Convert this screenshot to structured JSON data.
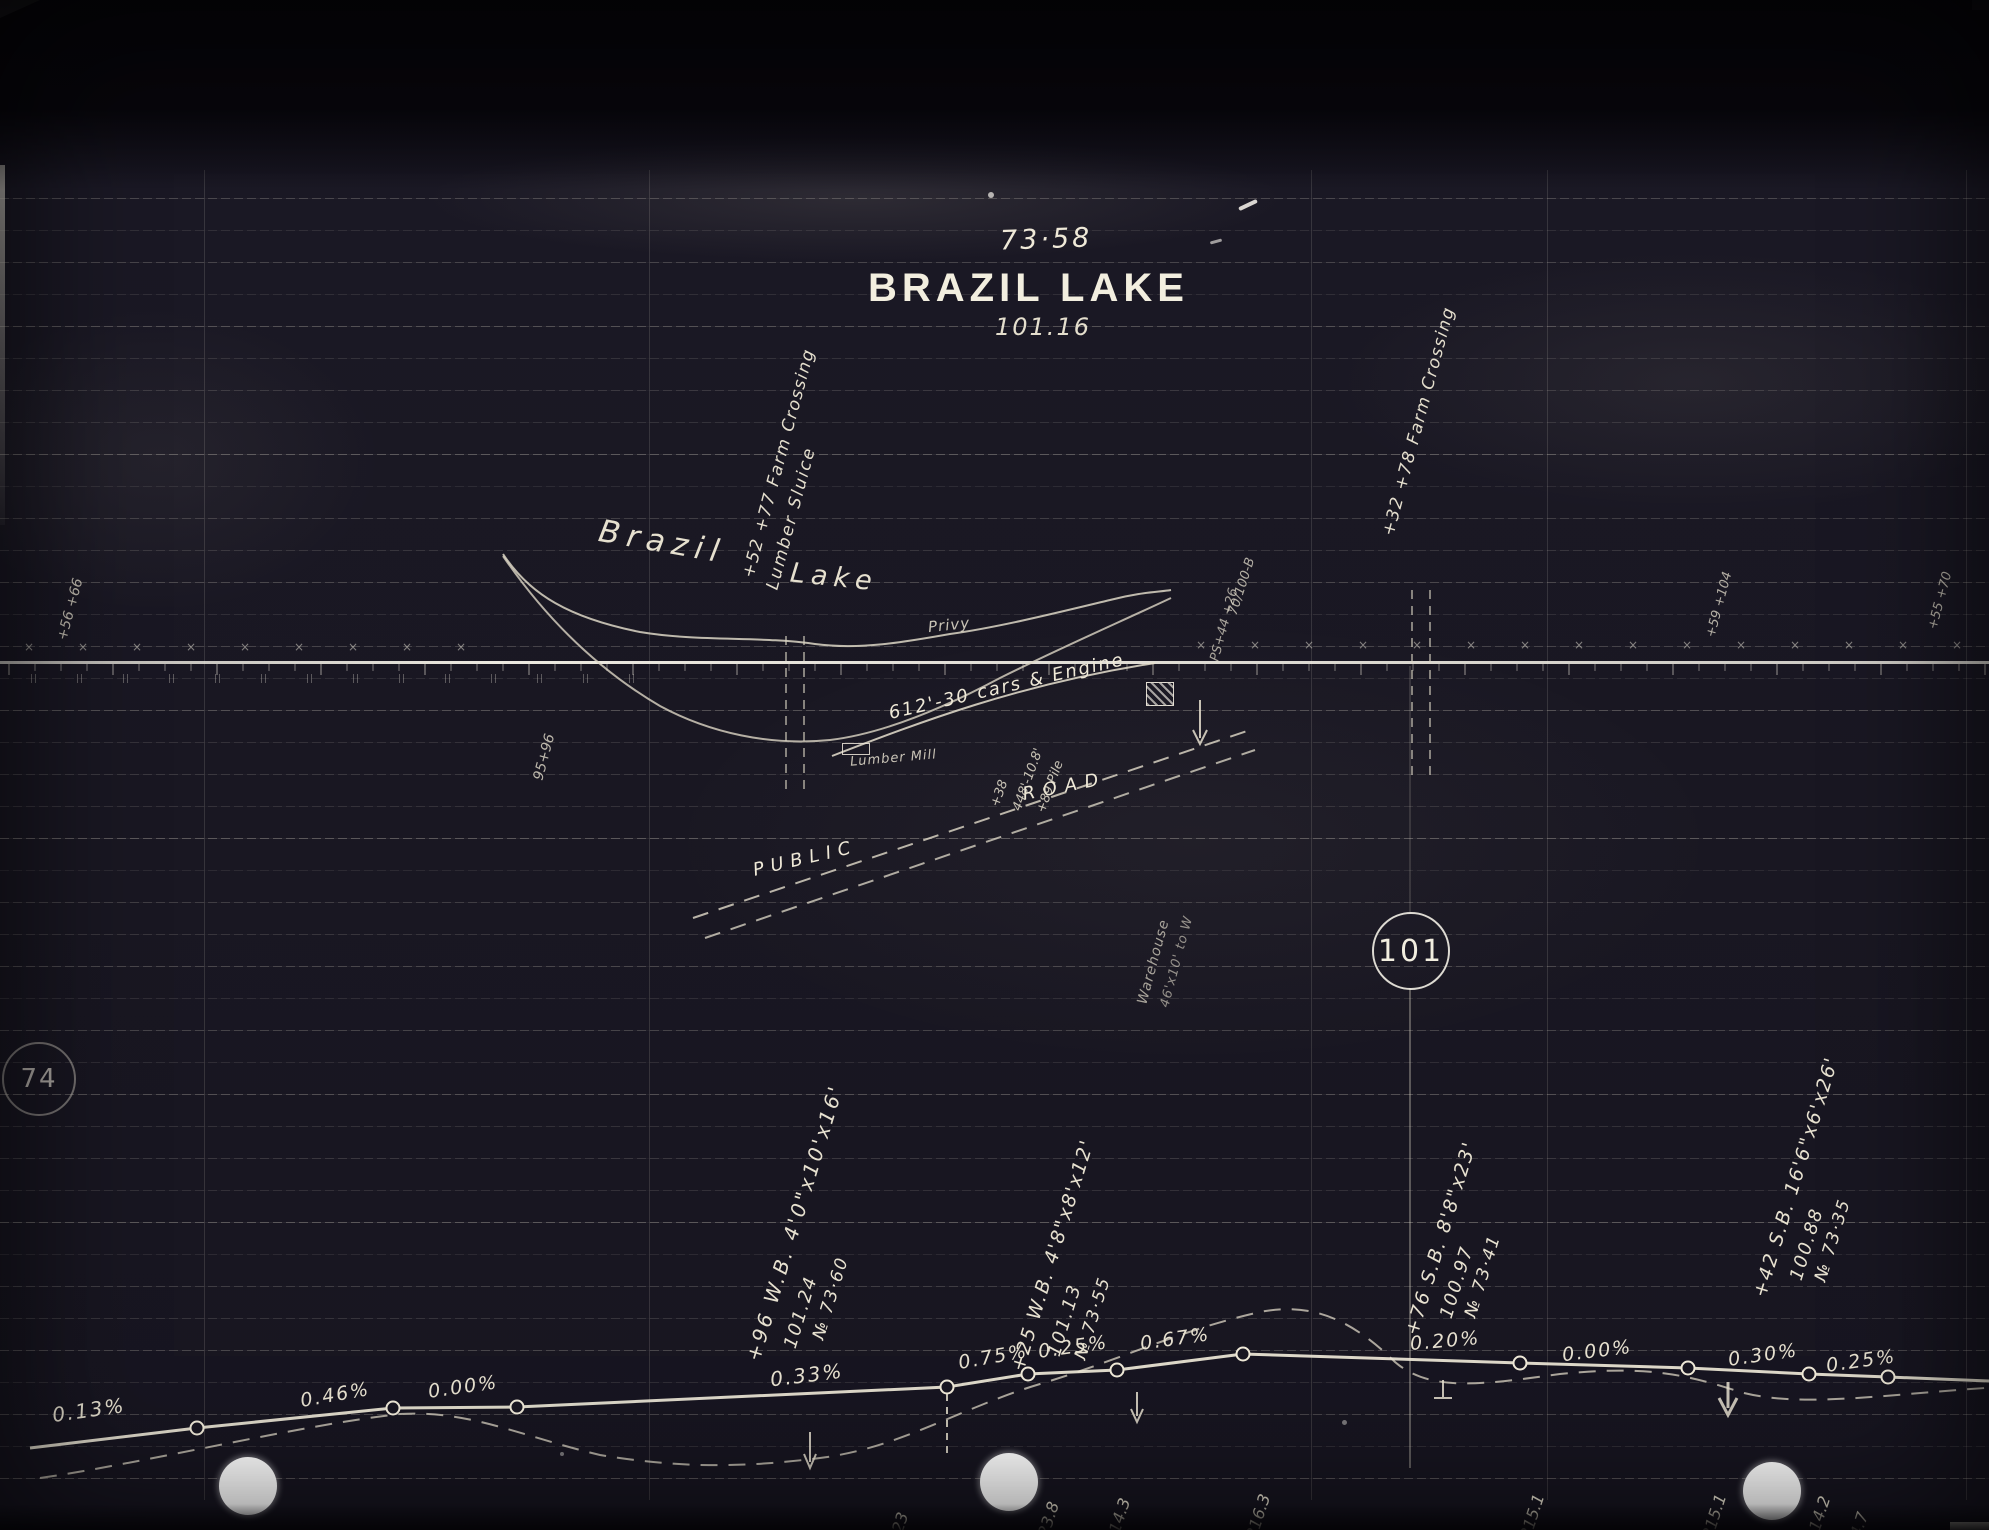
{
  "colors": {
    "paper": "#191722",
    "ink": "#e9e3d2",
    "ink_bright": "#f7f4ea",
    "grid": "#cfc9b8",
    "hole": "#ffffff"
  },
  "title": {
    "mileage_a": "73·58",
    "name": "BRAZIL LAKE",
    "mileage_b": "101.16"
  },
  "mile_markers": {
    "circle_right": "101",
    "circle_left": "74"
  },
  "plan": {
    "lake_name_line1": "Brazil",
    "lake_name_line2": "Lake",
    "privy": "Privy",
    "siding": "612'-30 cars & Engine",
    "lumber_mill": "Lumber Mill",
    "road_word1": "PUBLIC",
    "road_word2": "ROAD",
    "crossing_left_line1": "+52 +77 Farm Crossing",
    "crossing_left_line2": "Lumber Sluice",
    "crossing_right": "+32 +78 Farm Crossing",
    "warehouse_line1": "Warehouse",
    "warehouse_line2": "46'x10' to W",
    "siding_note_line1": "+38",
    "siding_note_line2": "448'-10.8'",
    "siding_note_line3": "+89 Pile",
    "station_left": "+56 +66",
    "station_ps": "95+96",
    "station_70_100": "70/100-B",
    "station_ps44": "PS+44 +26",
    "station_right_a": "+59 +104",
    "station_right_b": "+55 +70"
  },
  "culvert_notes": [
    {
      "line1": "+96 W.B. 4'0\"x10'x16'",
      "line2": "101.24",
      "line3": "№ 73·60"
    },
    {
      "line1": "+25 W.B. 4'8\"x8'x12'",
      "line2": "101.13",
      "line3": "№ 73·55"
    },
    {
      "line1": "+76 S.B. 8'8\"x23'",
      "line2": "100.97",
      "line3": "№ 73·41"
    },
    {
      "line1": "+42 S.B. 16'6\"x6'x26'",
      "line2": "100.88",
      "line3": "№ 73·35"
    }
  ],
  "profile": {
    "grades": [
      "0.13%",
      "0.46%",
      "0.00%",
      "0.33%",
      "0.75%",
      "0.25%",
      "0.67%",
      "0.20%",
      "0.00%",
      "0.30%",
      "0.25%"
    ],
    "elevations": [
      "9",
      "9",
      "23",
      "23.8",
      "214.3",
      "216.3",
      "215.1",
      "215.1",
      "214.2",
      "214.7"
    ]
  }
}
